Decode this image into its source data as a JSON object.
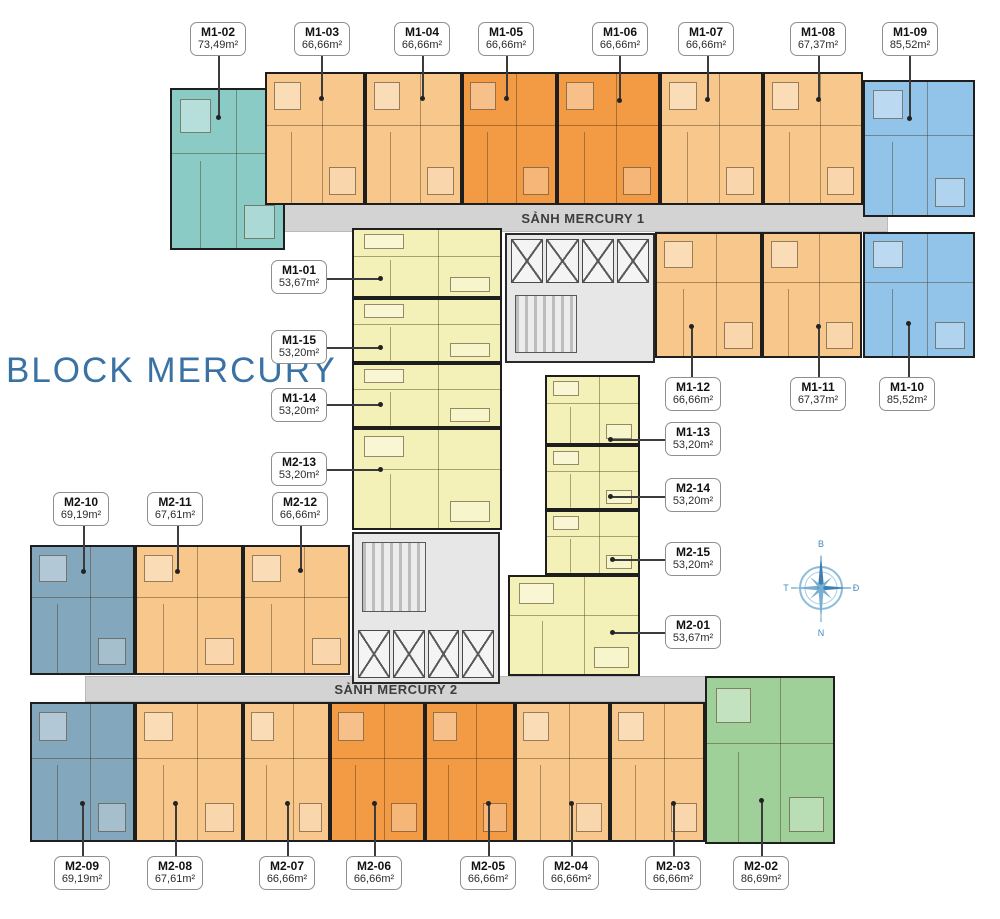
{
  "title": "BLOCK MERCURY",
  "corridors": [
    {
      "label": "SẢNH MERCURY 1"
    },
    {
      "label": "SẢNH MERCURY 2"
    }
  ],
  "compass": {
    "north": "B",
    "east": "Đ",
    "south": "N",
    "west": "T"
  },
  "palette": {
    "teal": "#8acbc6",
    "peach": "#f7c78c",
    "orange": "#f29a44",
    "yellow": "#f4f1b8",
    "blue": "#92c4e9",
    "slate": "#83a7bd",
    "green": "#9fd099",
    "corridor_gray": "#d3d3d3",
    "title_blue": "#3a72a4",
    "compass_blue": "#4489bd"
  },
  "units": [
    {
      "id": "M1-01",
      "area": "53,67m²"
    },
    {
      "id": "M1-02",
      "area": "73,49m²"
    },
    {
      "id": "M1-03",
      "area": "66,66m²"
    },
    {
      "id": "M1-04",
      "area": "66,66m²"
    },
    {
      "id": "M1-05",
      "area": "66,66m²"
    },
    {
      "id": "M1-06",
      "area": "66,66m²"
    },
    {
      "id": "M1-07",
      "area": "66,66m²"
    },
    {
      "id": "M1-08",
      "area": "67,37m²"
    },
    {
      "id": "M1-09",
      "area": "85,52m²"
    },
    {
      "id": "M1-10",
      "area": "85,52m²"
    },
    {
      "id": "M1-11",
      "area": "67,37m²"
    },
    {
      "id": "M1-12",
      "area": "66,66m²"
    },
    {
      "id": "M1-13",
      "area": "53,20m²"
    },
    {
      "id": "M1-14",
      "area": "53,20m²"
    },
    {
      "id": "M1-15",
      "area": "53,20m²"
    },
    {
      "id": "M2-01",
      "area": "53,67m²"
    },
    {
      "id": "M2-02",
      "area": "86,69m²"
    },
    {
      "id": "M2-03",
      "area": "66,66m²"
    },
    {
      "id": "M2-04",
      "area": "66,66m²"
    },
    {
      "id": "M2-05",
      "area": "66,66m²"
    },
    {
      "id": "M2-06",
      "area": "66,66m²"
    },
    {
      "id": "M2-07",
      "area": "66,66m²"
    },
    {
      "id": "M2-08",
      "area": "67,61m²"
    },
    {
      "id": "M2-09",
      "area": "69,19m²"
    },
    {
      "id": "M2-10",
      "area": "69,19m²"
    },
    {
      "id": "M2-11",
      "area": "67,61m²"
    },
    {
      "id": "M2-12",
      "area": "66,66m²"
    },
    {
      "id": "M2-13",
      "area": "53,20m²"
    },
    {
      "id": "M2-14",
      "area": "53,20m²"
    },
    {
      "id": "M2-15",
      "area": "53,20m²"
    }
  ]
}
